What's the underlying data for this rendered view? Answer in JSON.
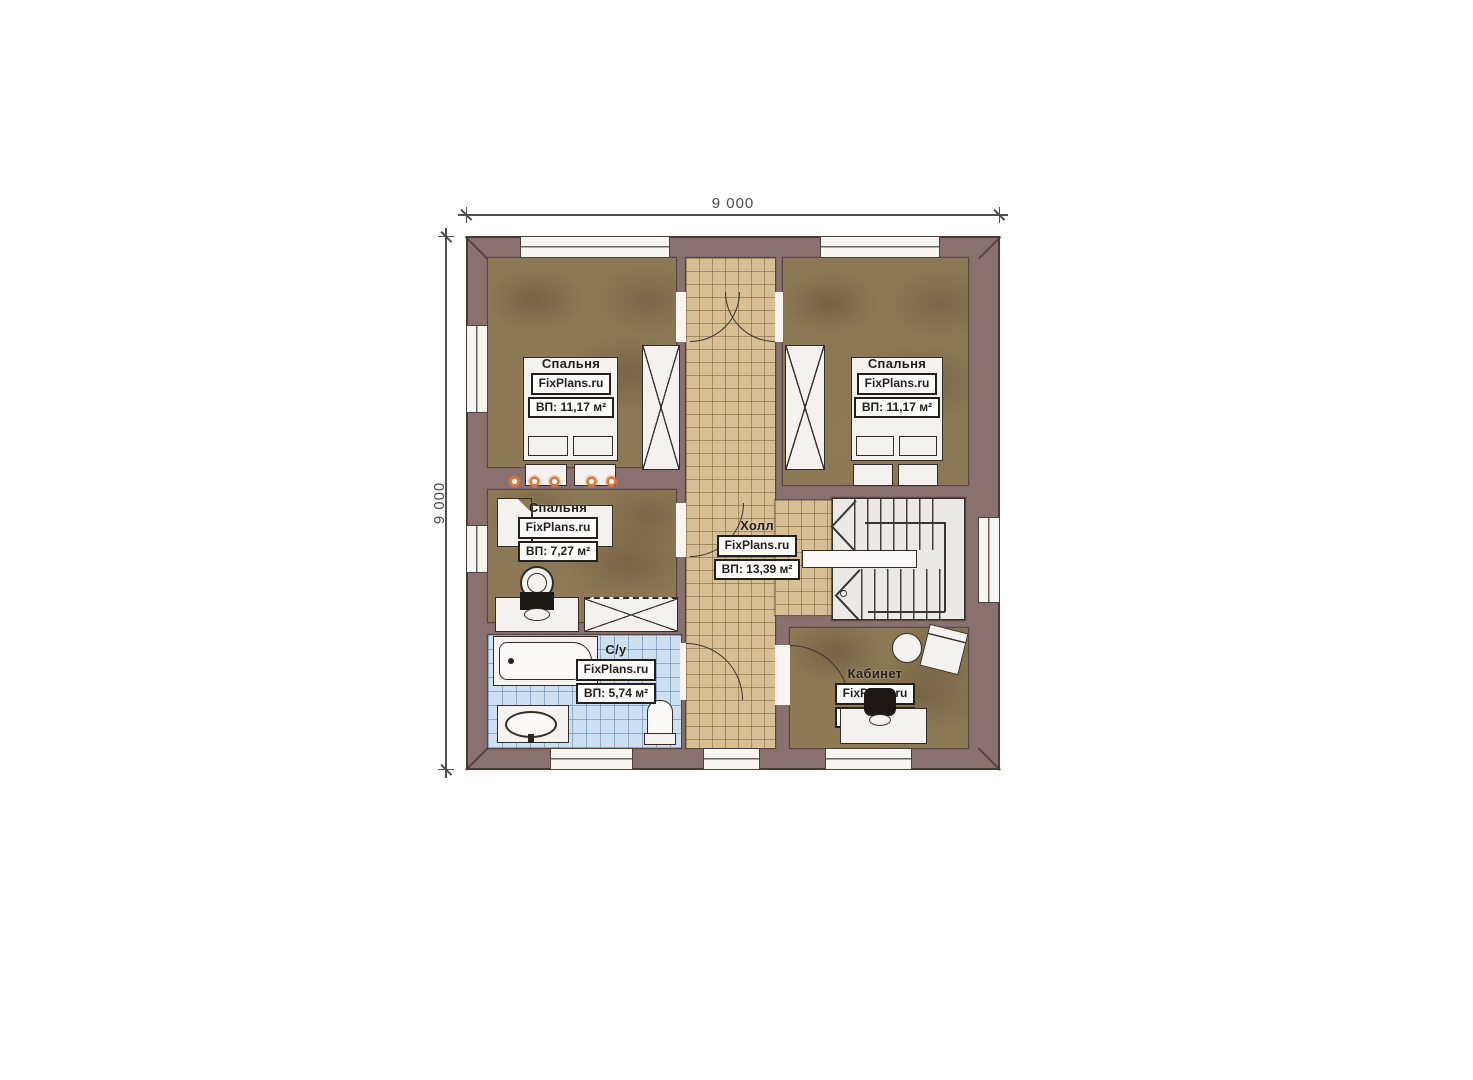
{
  "page": {
    "width": 1473,
    "height": 1080,
    "background": "#ffffff"
  },
  "dimensions": {
    "top_label": "9 000",
    "left_label": "9 000"
  },
  "colors": {
    "wall": "#8a7170",
    "bedroom_floor": "#8d7855",
    "corridor_tile": "#d7bf93",
    "bathroom_tile": "#cde0f2",
    "furniture": "#f3f2ee",
    "stairs": "#ebe9e5",
    "light_dot": "#e2773e",
    "label_text": "#241f1b"
  },
  "rooms": {
    "bedroom_top_left": {
      "name": "Спальня",
      "brand": "FixPlans.ru",
      "area": "ВП: 11,17 м²"
    },
    "bedroom_top_right": {
      "name": "Спальня",
      "brand": "FixPlans.ru",
      "area": "ВП: 11,17 м²"
    },
    "bedroom_small": {
      "name": "Спальня",
      "brand": "FixPlans.ru",
      "area": "ВП: 7,27 м²"
    },
    "hall": {
      "name": "Холл",
      "brand": "FixPlans.ru",
      "area": "ВП: 13,39 м²"
    },
    "bathroom": {
      "name": "С/у",
      "brand": "FixPlans.ru",
      "area": "ВП: 5,74 м²"
    },
    "office": {
      "name": "Кабинет",
      "brand": "FixPlans.ru",
      "area": "ВП: 5,78 м²"
    }
  }
}
